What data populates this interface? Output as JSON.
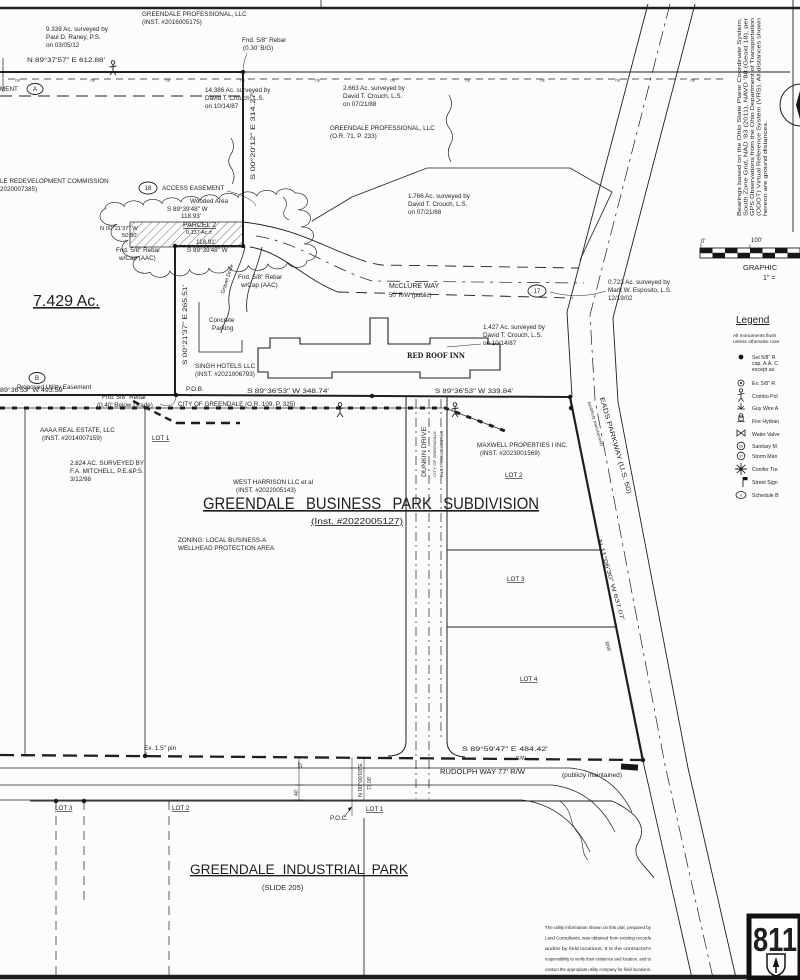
{
  "colors": {
    "ink": "#1f1f1f",
    "paper": "#fcfcfa"
  },
  "labels": [
    {
      "n": "acreage-9-339",
      "x": 46,
      "y": 31,
      "t": "9.339 Ac. surveyed by"
    },
    {
      "x": 46,
      "y": 39,
      "t": "Paul D. Raney, P.S."
    },
    {
      "x": 46,
      "y": 47,
      "t": "on 03/05/12"
    },
    {
      "n": "owner-greendale-professional",
      "x": 142,
      "y": 16,
      "t": "GREENDALE PROFESSIONAL, LLC"
    },
    {
      "x": 142,
      "y": 24,
      "t": "(INST. #2016005175)"
    },
    {
      "n": "found-rebar-north",
      "x": 242,
      "y": 42,
      "t": "Fnd. 5/8\" Rebar"
    },
    {
      "x": 243,
      "y": 50,
      "t": "(0.30' B/G)"
    },
    {
      "n": "bearing-north-line",
      "x": 27,
      "y": 62,
      "t": "N 89°37'57\" E   612.88'",
      "tl": 78
    },
    {
      "x": 0,
      "y": 91,
      "t": "MENT"
    },
    {
      "n": "easement-a-label",
      "x": 35,
      "y": 91,
      "t": "A",
      "a": "middle",
      "s": 6
    },
    {
      "x": 205,
      "y": 92,
      "t": "14.386 Ac. surveyed by"
    },
    {
      "x": 205,
      "y": 100,
      "t": "David T. Crouch, L.S."
    },
    {
      "x": 205,
      "y": 108,
      "t": "on 10/14/87"
    },
    {
      "x": 343,
      "y": 90,
      "t": "2.663 Ac. surveyed by"
    },
    {
      "x": 343,
      "y": 98,
      "t": "David T. Crouch, L.S."
    },
    {
      "x": 343,
      "y": 106,
      "t": "on 07/21/88"
    },
    {
      "x": 330,
      "y": 130,
      "t": "GREENDALE PROFESSIONAL, LLC"
    },
    {
      "x": 330,
      "y": 138,
      "t": "(O.R. 71, P. 233)"
    },
    {
      "n": "bearing-east-parcel",
      "x": 255,
      "y": 180,
      "t": "S 00°20'12\" E   314.27'",
      "r": -90,
      "tl": 88
    },
    {
      "x": 0,
      "y": 183,
      "t": "LE REDEVELOPMENT COMMISSION"
    },
    {
      "x": 0,
      "y": 191,
      "t": "2020007385)"
    },
    {
      "n": "easement-18-label",
      "x": 148,
      "y": 190,
      "t": "18",
      "a": "middle",
      "s": 6
    },
    {
      "x": 162,
      "y": 190,
      "t": "ACCESS EASEMENT"
    },
    {
      "x": 408,
      "y": 198,
      "t": "1.766 Ac. surveyed by"
    },
    {
      "x": 408,
      "y": 206,
      "t": "David T. Crouch, L.S."
    },
    {
      "x": 408,
      "y": 214,
      "t": "on 07/21/88"
    },
    {
      "x": 190,
      "y": 203,
      "t": "Wooded Area"
    },
    {
      "x": 167,
      "y": 211,
      "t": "S 89°39'48\" W"
    },
    {
      "x": 181,
      "y": 218,
      "t": "118.93'"
    },
    {
      "n": "parcel-2-label",
      "x": 183,
      "y": 227,
      "t": "PARCEL 2",
      "s": 7,
      "u": 1
    },
    {
      "x": 186,
      "y": 234,
      "t": "0.137 Ac.±",
      "s": 5.5
    },
    {
      "x": 100,
      "y": 230,
      "t": "N 00°21'37\" W",
      "s": 5.8
    },
    {
      "x": 122,
      "y": 237,
      "t": "50.90'",
      "s": 5.8
    },
    {
      "x": 196,
      "y": 244,
      "t": "118.91'"
    },
    {
      "x": 187,
      "y": 252,
      "t": "S 89°39'48\" W"
    },
    {
      "x": 116,
      "y": 252,
      "t": "Fnd. 5/8\" Rebar"
    },
    {
      "x": 119,
      "y": 260,
      "t": "w/Cap (AAC)"
    },
    {
      "x": 238,
      "y": 279,
      "t": "Fnd. 5/8\" Rebar"
    },
    {
      "x": 241,
      "y": 287,
      "t": "w/Cap (AAC)"
    },
    {
      "n": "gravel-drive-label",
      "x": 224,
      "y": 294,
      "t": "Gravel Drive",
      "r": -72,
      "s": 5.5
    },
    {
      "n": "mcclure-way-label",
      "x": 389,
      "y": 288,
      "t": "McCLURE WAY",
      "s": 7
    },
    {
      "x": 389,
      "y": 297,
      "t": "50' R/W (public)",
      "s": 6
    },
    {
      "n": "parcel-17-label",
      "x": 537,
      "y": 293,
      "t": "17",
      "a": "middle",
      "s": 6
    },
    {
      "x": 608,
      "y": 284,
      "t": "0.723 Ac. surveyed by"
    },
    {
      "x": 608,
      "y": 292,
      "t": "Mark W. Esposito, L.S."
    },
    {
      "x": 608,
      "y": 300,
      "t": "12/19/02"
    },
    {
      "n": "acreage-7-429",
      "x": 33,
      "y": 306,
      "t": "7.429 Ac.",
      "s": 16,
      "u": 1
    },
    {
      "n": "bearing-west-line",
      "x": 187,
      "y": 365,
      "t": "S 00°21'37\" E   265.51'",
      "r": -90,
      "tl": 80
    },
    {
      "x": 209,
      "y": 322,
      "t": "Concrete"
    },
    {
      "x": 212,
      "y": 330,
      "t": "Parking"
    },
    {
      "x": 483,
      "y": 329,
      "t": "1.427 Ac. surveyed by"
    },
    {
      "x": 483,
      "y": 337,
      "t": "David T. Crouch, L.S."
    },
    {
      "x": 483,
      "y": 345,
      "t": "on 10/14/87"
    },
    {
      "n": "red-roof-inn-label",
      "x": 407,
      "y": 358,
      "t": "RED ROOF INN",
      "s": 7,
      "b": 1,
      "f": "serif",
      "tl": 58
    },
    {
      "n": "owner-singh-hotels",
      "x": 195,
      "y": 368,
      "t": "SINGH HOTELS LLC"
    },
    {
      "x": 195,
      "y": 376,
      "t": "(INST. #2021006793)"
    },
    {
      "x": 102,
      "y": 399,
      "t": "Fnd. 5/8\" Rebar"
    },
    {
      "x": 97,
      "y": 407,
      "t": "(0.40' Below Grade)"
    },
    {
      "n": "easement-b-label",
      "x": 37,
      "y": 380,
      "t": "B",
      "a": "middle",
      "s": 6
    },
    {
      "x": 17,
      "y": 389,
      "t": "Proposed Utility Easement"
    },
    {
      "x": 0,
      "y": 392,
      "t": "89°36'53\" W   493.59'",
      "tl": 64
    },
    {
      "n": "pob-label",
      "x": 186,
      "y": 391,
      "t": "P.O.B."
    },
    {
      "n": "bearing-south-1",
      "x": 247,
      "y": 393,
      "t": "S 89°36'53\" W   348.74'",
      "tl": 82
    },
    {
      "n": "bearing-south-2",
      "x": 435,
      "y": 393,
      "t": "S 89°36'53\" W   339.84'",
      "tl": 78
    },
    {
      "x": 178,
      "y": 406,
      "t": "CITY OF GREENDALE   (O.R. 109, P. 325)"
    },
    {
      "n": "owner-aaaa-real-estate",
      "x": 40,
      "y": 432,
      "t": "AAAA REAL ESTATE, LLC"
    },
    {
      "x": 42,
      "y": 440,
      "t": "(INST. #2014007159)"
    },
    {
      "n": "lot-1-business",
      "x": 152,
      "y": 440,
      "t": "LOT 1",
      "u": 1
    },
    {
      "x": 70,
      "y": 465,
      "t": "2.824 AC. SURVEYED BY"
    },
    {
      "x": 70,
      "y": 473,
      "t": "F.A. MITCHELL, P.E.&P.S."
    },
    {
      "x": 70,
      "y": 481,
      "t": "3/12/98"
    },
    {
      "n": "dunkin-drive-label",
      "x": 426,
      "y": 477,
      "t": "DUNKIN DRIVE",
      "r": -90,
      "s": 6.5,
      "tl": 50
    },
    {
      "x": 436,
      "y": 477,
      "t": "CITY OF GREENDALE",
      "r": -90,
      "s": 3.8,
      "tl": 46
    },
    {
      "x": 443,
      "y": 477,
      "t": "INST. #2022004789",
      "r": -90,
      "s": 3.8,
      "tl": 46
    },
    {
      "n": "owner-maxwell",
      "x": 477,
      "y": 447,
      "t": "MAXWELL PROPERTIES I INC."
    },
    {
      "x": 480,
      "y": 455,
      "t": "(INST. #2023001569)"
    },
    {
      "n": "lot-2-label",
      "x": 505,
      "y": 477,
      "t": "LOT 2",
      "u": 1
    },
    {
      "n": "owner-west-harrison",
      "x": 233,
      "y": 484,
      "t": "WEST HARRISON LLC et al"
    },
    {
      "x": 236,
      "y": 492,
      "t": "(INST. #2022005143)"
    },
    {
      "n": "subdivision-title",
      "x": 203,
      "y": 509,
      "t": "GREENDALE BUSINESS PARK SUBDIVISION",
      "s": 16.5,
      "u": 1,
      "tl": 336,
      "ws": 8
    },
    {
      "n": "subdivision-inst",
      "x": 311,
      "y": 524,
      "t": "(Inst. #2022005127)",
      "s": 8.5,
      "u": 1,
      "tl": 92
    },
    {
      "x": 178,
      "y": 542,
      "t": "ZONING: LOCAL BUSINESS-A"
    },
    {
      "x": 178,
      "y": 550,
      "t": "WELLHEAD PROTECTION AREA"
    },
    {
      "n": "lot-3-label",
      "x": 507,
      "y": 581,
      "t": "LOT 3",
      "u": 1
    },
    {
      "n": "lot-4-label",
      "x": 520,
      "y": 681,
      "t": "LOT 4",
      "u": 1
    },
    {
      "n": "eads-parkway-label",
      "x": 600,
      "y": 398,
      "t": "EADS PARKWAY (U.S. 50)",
      "r": 74,
      "s": 6.5,
      "tl": 100
    },
    {
      "x": 588,
      "y": 402,
      "t": "(publicly maintained)",
      "r": 74,
      "s": 4,
      "tl": 46
    },
    {
      "n": "bearing-eads",
      "x": 598,
      "y": 540,
      "t": "N 11°06'30\" W   637.07'",
      "r": 74,
      "s": 5.5,
      "tl": 84
    },
    {
      "x": 605,
      "y": 642,
      "t": "R/W",
      "r": 74,
      "s": 5
    },
    {
      "n": "bearing-rudolph",
      "x": 462,
      "y": 751,
      "t": "S 89°59'47\" E   484.42'",
      "tl": 86
    },
    {
      "x": 516,
      "y": 760,
      "t": "R/W",
      "s": 5
    },
    {
      "n": "rudolph-way-label",
      "x": 440,
      "y": 774,
      "t": "RUDOLPH WAY 77' R/W",
      "s": 7,
      "tl": 85
    },
    {
      "x": 562,
      "y": 777,
      "t": "(publicly maintained)",
      "s": 6,
      "tl": 60
    },
    {
      "x": 144,
      "y": 750,
      "t": "Ex. 1.5\" pin"
    },
    {
      "x": 302,
      "y": 768,
      "t": "37'",
      "r": -90,
      "s": 5
    },
    {
      "x": 298,
      "y": 796,
      "t": "40'",
      "r": -90,
      "s": 5
    },
    {
      "x": 362,
      "y": 797,
      "t": "N 00°00'03\"E",
      "r": -90,
      "s": 5,
      "tl": 34
    },
    {
      "x": 371,
      "y": 790,
      "t": "77.00'",
      "r": -90,
      "s": 5
    },
    {
      "n": "poc-label",
      "x": 330,
      "y": 820,
      "t": "P.O.C."
    },
    {
      "n": "lot-1-industrial",
      "x": 366,
      "y": 811,
      "t": "LOT 1",
      "u": 1
    },
    {
      "x": 172,
      "y": 810,
      "t": "LOT 2",
      "u": 1
    },
    {
      "x": 55,
      "y": 810,
      "t": "LOT 3",
      "u": 1
    },
    {
      "n": "industrial-park-title",
      "x": 190,
      "y": 874,
      "t": "GREENDALE INDUSTRIAL PARK",
      "s": 13.5,
      "u": 1,
      "tl": 218,
      "ws": 4
    },
    {
      "x": 262,
      "y": 890,
      "t": "(SLIDE 205)",
      "s": 7.5
    },
    {
      "n": "utility-note-1",
      "x": 545,
      "y": 929,
      "t": "The utility information shown on this plat, prepared by",
      "s": 4.8,
      "tl": 106
    },
    {
      "x": 545,
      "y": 939.5,
      "t": "Land Consultants, was obtained from existing records",
      "s": 4.8,
      "tl": 106
    },
    {
      "x": 545,
      "y": 950,
      "t": "and/or by field locations. It is the contractor's",
      "s": 4.8,
      "tl": 106
    },
    {
      "x": 545,
      "y": 960.5,
      "t": "responsibility to verify their existence and location, and to",
      "s": 4.8,
      "tl": 106
    },
    {
      "x": 545,
      "y": 971,
      "t": "contact the appropiate utility company for field locations.",
      "s": 4.8,
      "tl": 106
    },
    {
      "n": "call-811-number",
      "x": 753,
      "y": 951,
      "t": "811",
      "s": 33,
      "b": 1,
      "tl": 44
    },
    {
      "n": "legend-title",
      "x": 736,
      "y": 323,
      "t": "Legend",
      "s": 10,
      "u": 1
    },
    {
      "x": 733,
      "y": 337,
      "t": "All monuments flush",
      "s": 4.8
    },
    {
      "x": 733,
      "y": 343,
      "t": "unless otherwise note",
      "s": 4.8
    },
    {
      "x": 752,
      "y": 359,
      "t": "Set 5/8\" R",
      "s": 5.2
    },
    {
      "x": 752,
      "y": 365,
      "t": "cap, A.A. C",
      "s": 5.2
    },
    {
      "x": 752,
      "y": 371,
      "t": "except as",
      "s": 5.2
    },
    {
      "x": 752,
      "y": 385,
      "t": "Ex. 5/8\" R",
      "s": 5.2
    },
    {
      "x": 752,
      "y": 398,
      "t": "Combo Pol",
      "s": 5.2
    },
    {
      "x": 752,
      "y": 410,
      "t": "Guy Wire A",
      "s": 5.2
    },
    {
      "x": 752,
      "y": 423,
      "t": "Fire Hydran",
      "s": 5.2
    },
    {
      "x": 752,
      "y": 436,
      "t": "Water Valve",
      "s": 5.2
    },
    {
      "x": 752,
      "y": 448,
      "t": "Sanitary M",
      "s": 5.2
    },
    {
      "x": 752,
      "y": 458,
      "t": "Storm Man",
      "s": 5.2
    },
    {
      "x": 752,
      "y": 471,
      "t": "Conifer Tre",
      "s": 5.2
    },
    {
      "x": 752,
      "y": 484,
      "t": "Street Sign",
      "s": 5.2
    },
    {
      "x": 752,
      "y": 497,
      "t": "Schedule B",
      "s": 5.2
    },
    {
      "x": 741,
      "y": 447.3,
      "t": "SS",
      "s": 3.2,
      "a": "middle"
    },
    {
      "x": 741,
      "y": 457.3,
      "t": "ST",
      "s": 3.2,
      "a": "middle"
    },
    {
      "x": 741,
      "y": 496.3,
      "t": "n",
      "s": 4,
      "i": 1,
      "a": "middle"
    },
    {
      "n": "scale-0",
      "x": 701,
      "y": 243,
      "t": "0'",
      "s": 6
    },
    {
      "n": "scale-100",
      "x": 751,
      "y": 242,
      "t": "100'",
      "s": 6
    },
    {
      "n": "scale-graphic",
      "x": 743,
      "y": 270,
      "t": "GRAPHIC",
      "s": 7.5
    },
    {
      "x": 763,
      "y": 280,
      "t": "1\" =",
      "s": 7
    },
    {
      "n": "bearings-note-1",
      "x": 741,
      "y": 216,
      "t": "Bearings based on the Ohio State Plane Coordinate System,",
      "r": -90,
      "s": 5,
      "tl": 198
    },
    {
      "x": 747.5,
      "y": 216,
      "t": "South Zone Grid, NAD '83 (2011), NAVD '88 (Geoid 18), per",
      "r": -90,
      "s": 5,
      "tl": 198
    },
    {
      "x": 754,
      "y": 216,
      "t": "GPS Observations from the Ohio Department of Transportation",
      "r": -90,
      "s": 5,
      "tl": 198
    },
    {
      "x": 760.5,
      "y": 216,
      "t": "(ODOT) Virtual Reference System (VRS). All distances shown",
      "r": -90,
      "s": 5,
      "tl": 198
    },
    {
      "x": 767,
      "y": 216,
      "t": "hereon are ground distances.",
      "r": -90,
      "s": 5,
      "tl": 95
    },
    {
      "x": 15,
      "y": 81.5,
      "t": "OE",
      "s": 3.5
    },
    {
      "x": 90,
      "y": 81.5,
      "t": "OE",
      "s": 3.5
    },
    {
      "x": 165,
      "y": 81.5,
      "t": "OE",
      "s": 3.5
    },
    {
      "x": 240,
      "y": 81.5,
      "t": "OE",
      "s": 3.5
    },
    {
      "x": 315,
      "y": 81.5,
      "t": "OE",
      "s": 3.5
    },
    {
      "x": 390,
      "y": 81.5,
      "t": "OE",
      "s": 3.5
    },
    {
      "x": 465,
      "y": 81.5,
      "t": "OE",
      "s": 3.5
    },
    {
      "x": 540,
      "y": 81.5,
      "t": "OE",
      "s": 3.5
    },
    {
      "x": 615,
      "y": 81.5,
      "t": "OE",
      "s": 3.5
    },
    {
      "x": 690,
      "y": 81.5,
      "t": "OE",
      "s": 3.5
    }
  ]
}
